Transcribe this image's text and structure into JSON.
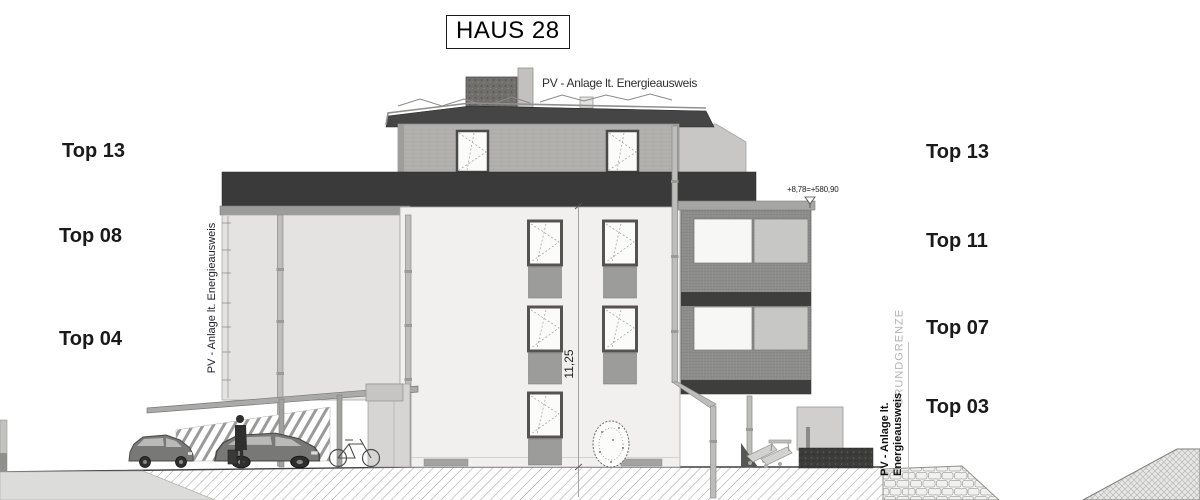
{
  "title": "HAUS 28",
  "drawing": {
    "roof_label": "PV - Anlage lt. Energieausweis",
    "left_wall_label": "PV - Anlage lt. Energieausweis",
    "right_wall_label_line1": "PV - Anlage lt.",
    "right_wall_label_line2": "Energieausweis",
    "boundary_label": "GRUNDGRENZE",
    "height_dimension": "11,25",
    "level_annotation": "+8,78=+580,90"
  },
  "unit_labels": {
    "left": [
      "Top 13",
      "Top 08",
      "Top 04"
    ],
    "right": [
      "Top 13",
      "Top 11",
      "Top 07",
      "Top 03"
    ]
  },
  "colors": {
    "dark_band": "#3a3a3a",
    "facade_light": "#f1f0ee",
    "penthouse_wall": "#b3b1ae",
    "balcony_mesh": "#8e8e8e",
    "panel_gray": "#9c9c9c",
    "label_text": "#1a1a1a",
    "boundary_text": "#b3b3b3"
  }
}
